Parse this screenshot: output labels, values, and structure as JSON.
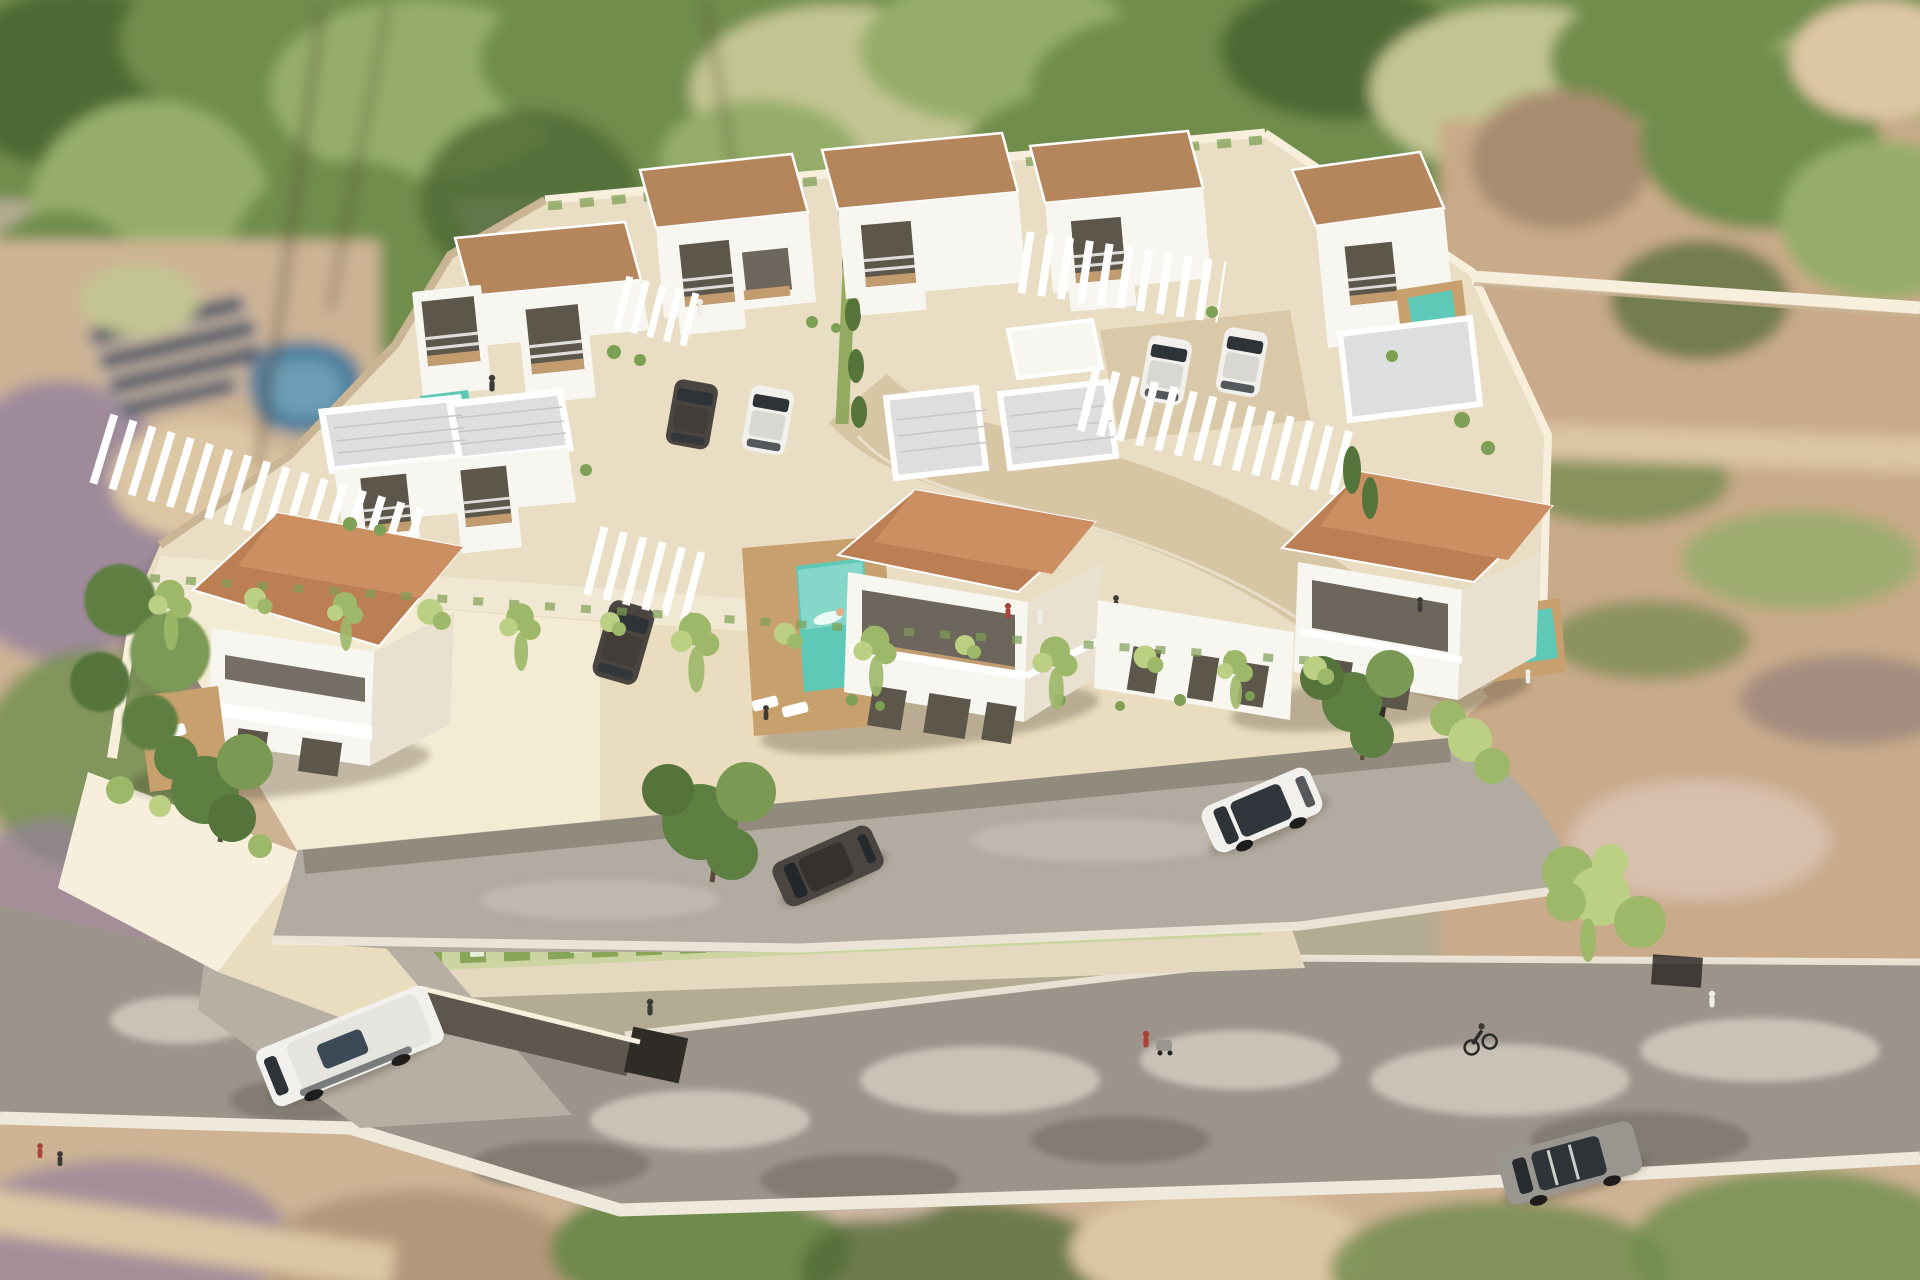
{
  "image": {
    "kind": "3D architectural aerial rendering",
    "subject": "Aerial render of a walled villa development with terracotta-roof houses, white flat-roof units, pools, pergolas, access road and surrounding streets",
    "width_px": 1920,
    "height_px": 1280
  },
  "colors": {
    "bg_base": "#b3ab92",
    "meadow": "#c2c493",
    "forest_green": "#6f8d4c",
    "forest_dark": "#4e6a36",
    "forest_light": "#95ad69",
    "scrub_purple": "#93809b",
    "scrub_dark": "#6d5f6d",
    "dirt_tan": "#c9aa8a",
    "dirt_light": "#ddc6a4",
    "dirt_dark": "#a98c6f",
    "dirt_pink": "#d9bfae",
    "lot_green": "#70894e",
    "lot_tan": "#cdb394",
    "pool_blue": "#4e7e9b",
    "pool_blue_light": "#74a5bd",
    "solar_panel": "#2d3d55",
    "panel_frame": "#cfd6df",
    "plot_ground": "#e9ddc3",
    "plot_light": "#f3ebd8",
    "plot_shade": "#d8c8aa",
    "wall_face": "#eaddbf",
    "wall_bright": "#f7efdc",
    "wall_shadow": "#c9b493",
    "ramp_dark": "#5d574e",
    "garage_dark": "#2f2c27",
    "apron_gray": "#b7afa3",
    "inner_road": "#b2aba1",
    "public_road": "#9c948b",
    "road_light": "#cac2b7",
    "road_dark": "#837b72",
    "curb_white": "#efe9db",
    "divider_cream": "#e4d8bf",
    "strip_green": "#89a557",
    "strip_light": "#c6d39a",
    "flower_white": "#edf1e1",
    "driveway_beige": "#d7c6a3",
    "roof_terracotta": "#bc7e53",
    "roof_terracotta_light": "#cb8f62",
    "roof_tan": "#b5855c",
    "roof_white_field": "#dedede",
    "roof_rib": "#c6c6c3",
    "villa_white": "#f8f6f0",
    "villa_cream": "#e9e0cf",
    "window_dark": "#5d564b",
    "interior_wood": "#c29b6e",
    "pool_teal": "#5ec9b7",
    "pool_teal_light": "#8fdccd",
    "deck_wood": "#c7a06d",
    "hedge_green": "#7da054",
    "cypress_green": "#55743c",
    "vine_green": "#9cb868",
    "vine_light": "#bcd084",
    "tree_green": "#5e7f42",
    "tree_light": "#7a9a54",
    "trunk_brown": "#6b5742",
    "car_dark": "#4a4540",
    "car_white": "#f1f0ec",
    "car_gray": "#999690",
    "glass_dark": "#2e3338",
    "shadow_soft": "rgba(55,45,30,0.28)",
    "person_dark": "#3c3a36",
    "person_white": "#f0ede6",
    "person_red": "#a94438",
    "skin": "#e0b08a"
  },
  "scene": {
    "surroundings": {
      "top": "blurred woodland with palm trees",
      "left": "neighbouring plot with blue swimming pool and ground-mounted solar panels",
      "right": "dry scrubland with dirt paths and boundary wall",
      "bottom": "blurred suburban plots beyond the public road"
    },
    "compound": {
      "perimeter": "cream rendered retaining walls with cascading vines",
      "front_row_villas": 3,
      "rear_villas": 5,
      "front_roof_style": "terracotta hip roof",
      "rear_roof_style": "tan and white flat roofs with boxed balconies",
      "pergolas": 5,
      "garage_ramp": "underground car-park entrance at lower left",
      "internal_driveway": "curved beige lane from the right-hand gate"
    },
    "pools": {
      "main_pool_with_swimmer": 1,
      "plunge_pools": 3,
      "neighbour_pool": 1
    },
    "vehicles": {
      "parked_inside_compound": 5,
      "white_suv_on_access_road": 1,
      "dark_car_on_access_road": 1,
      "white_van_on_public_road": 1,
      "grey_car_on_public_road": 1
    },
    "people": {
      "on_balconies": 5,
      "in_pool": 1,
      "on_deck": 1,
      "pedestrians_and_cyclist": 6
    }
  }
}
